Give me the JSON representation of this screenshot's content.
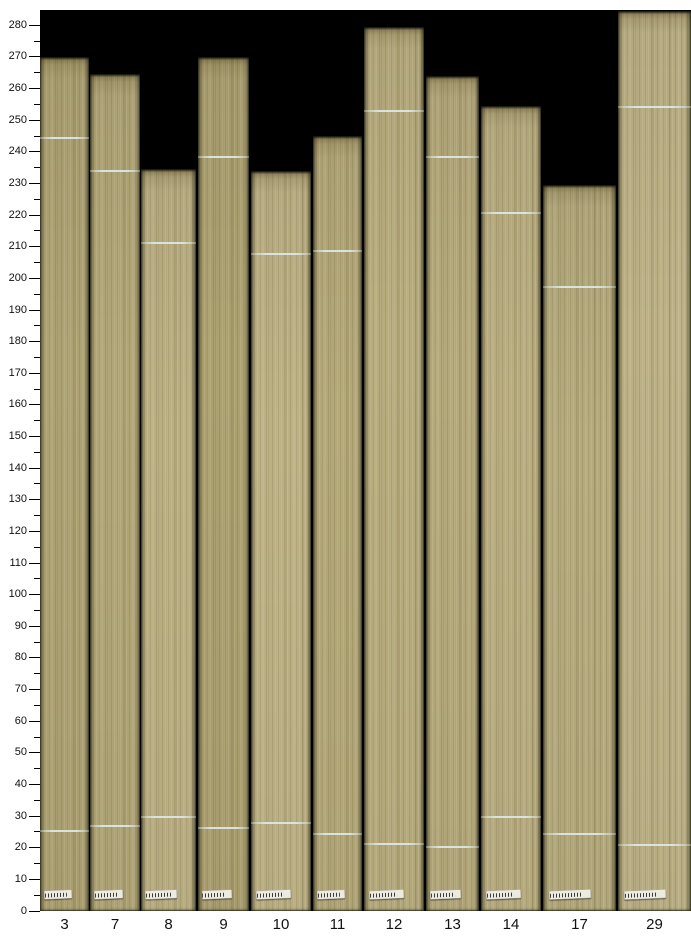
{
  "figure": {
    "title": "",
    "kind": "composite photo bar chart of wooden sample boards"
  },
  "colors": {
    "figure_background": "#ffffff",
    "plot_background": "#000000",
    "tick_color": "#000000",
    "label_color": "#111111",
    "chalk_mark": "#dde9e6",
    "sticker_face": "#edeadf",
    "sticker_bars": "#3a3a40"
  },
  "chart_data": {
    "type": "bar",
    "title": "",
    "xlabel": "",
    "ylabel": "",
    "categories": [
      "3",
      "7",
      "8",
      "9",
      "10",
      "11",
      "12",
      "13",
      "14",
      "17",
      "29"
    ],
    "values": [
      270,
      264.5,
      234.5,
      270,
      234,
      245,
      279.5,
      264,
      254.5,
      229.5,
      284.5
    ],
    "upper_marks": [
      244,
      233.5,
      211,
      238,
      207.5,
      208.5,
      252.5,
      238,
      220.5,
      197,
      254
    ],
    "lower_marks": [
      25,
      26.5,
      29.5,
      26,
      27.5,
      24,
      21,
      20,
      29.5,
      24,
      20.5
    ],
    "bar_x": [
      40,
      90,
      141,
      198,
      251,
      313,
      364,
      426,
      481,
      543,
      618
    ],
    "bar_widths": [
      49,
      50,
      55,
      51,
      60,
      49,
      60,
      53,
      60,
      73,
      73
    ],
    "bar_colors": [
      "#aea272",
      "#b2a677",
      "#bbaf82",
      "#aca06f",
      "#bdb184",
      "#b4a878",
      "#b8ac7d",
      "#b5a97a",
      "#b9ad80",
      "#b5aa7c",
      "#bcb084"
    ],
    "ylim": [
      0,
      285
    ],
    "y_major_step": 10,
    "y_minor_step": 5,
    "y_tick_labels": [
      "0",
      "10",
      "20",
      "30",
      "40",
      "50",
      "60",
      "70",
      "80",
      "90",
      "100",
      "110",
      "120",
      "130",
      "140",
      "150",
      "160",
      "170",
      "180",
      "190",
      "200",
      "210",
      "220",
      "230",
      "240",
      "250",
      "260",
      "270",
      "280"
    ],
    "grid": false,
    "legend": false,
    "bar_style": "photographic wood boards; pale chalk line crosses each board at upper_marks and lower_marks; small white barcode sticker near base of each board"
  }
}
